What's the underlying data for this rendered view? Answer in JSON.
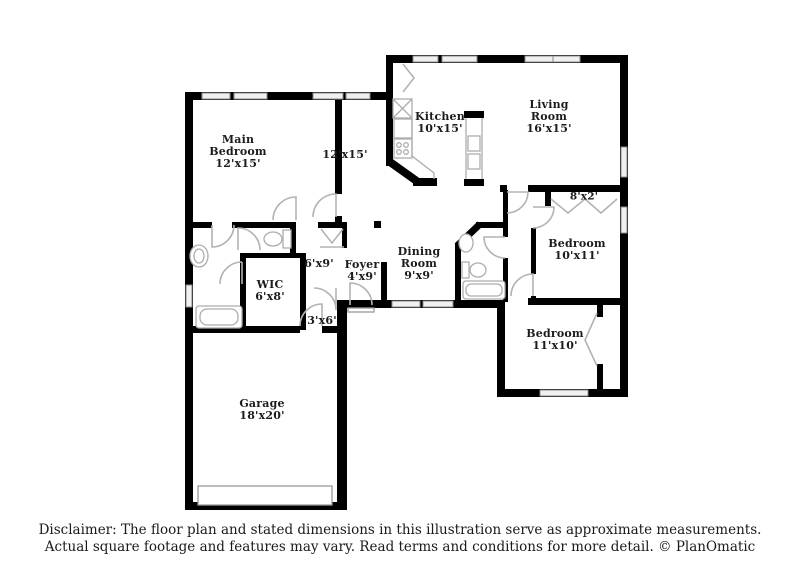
{
  "floorplan": {
    "rooms": {
      "main_bedroom": {
        "name": "Main Bedroom",
        "dims": "12'x15'"
      },
      "bonus_room": {
        "dims": "12'x15'"
      },
      "kitchen": {
        "name": "Kitchen",
        "dims": "10'x15'"
      },
      "living_room": {
        "name": "Living Room",
        "dims": "16'x15'"
      },
      "closet_8x2": {
        "dims": "8'x2'"
      },
      "bedroom_2": {
        "name": "Bedroom",
        "dims": "10'x11'"
      },
      "bedroom_3": {
        "name": "Bedroom",
        "dims": "11'x10'"
      },
      "dining_room": {
        "name": "Dining Room",
        "dims": "9'x9'"
      },
      "foyer": {
        "name": "Foyer",
        "dims": "4'x9'"
      },
      "hall_6x9": {
        "dims": "6'x9'"
      },
      "hall_3x6": {
        "dims": "3'x6'"
      },
      "wic": {
        "name": "WIC",
        "dims": "6'x8'"
      },
      "garage": {
        "name": "Garage",
        "dims": "18'x20'"
      }
    },
    "disclaimer": {
      "line1": "Disclaimer: The floor plan and stated dimensions in this illustration serve as approximate measurements.",
      "line2": "Actual square footage and features may vary. Read terms and conditions for more detail. © PlanOmatic"
    },
    "colors": {
      "wall": "#000000",
      "door_stroke": "#b3b3b3",
      "window_fill": "#f0f0f0",
      "window_stroke": "#8a8a8a"
    }
  }
}
